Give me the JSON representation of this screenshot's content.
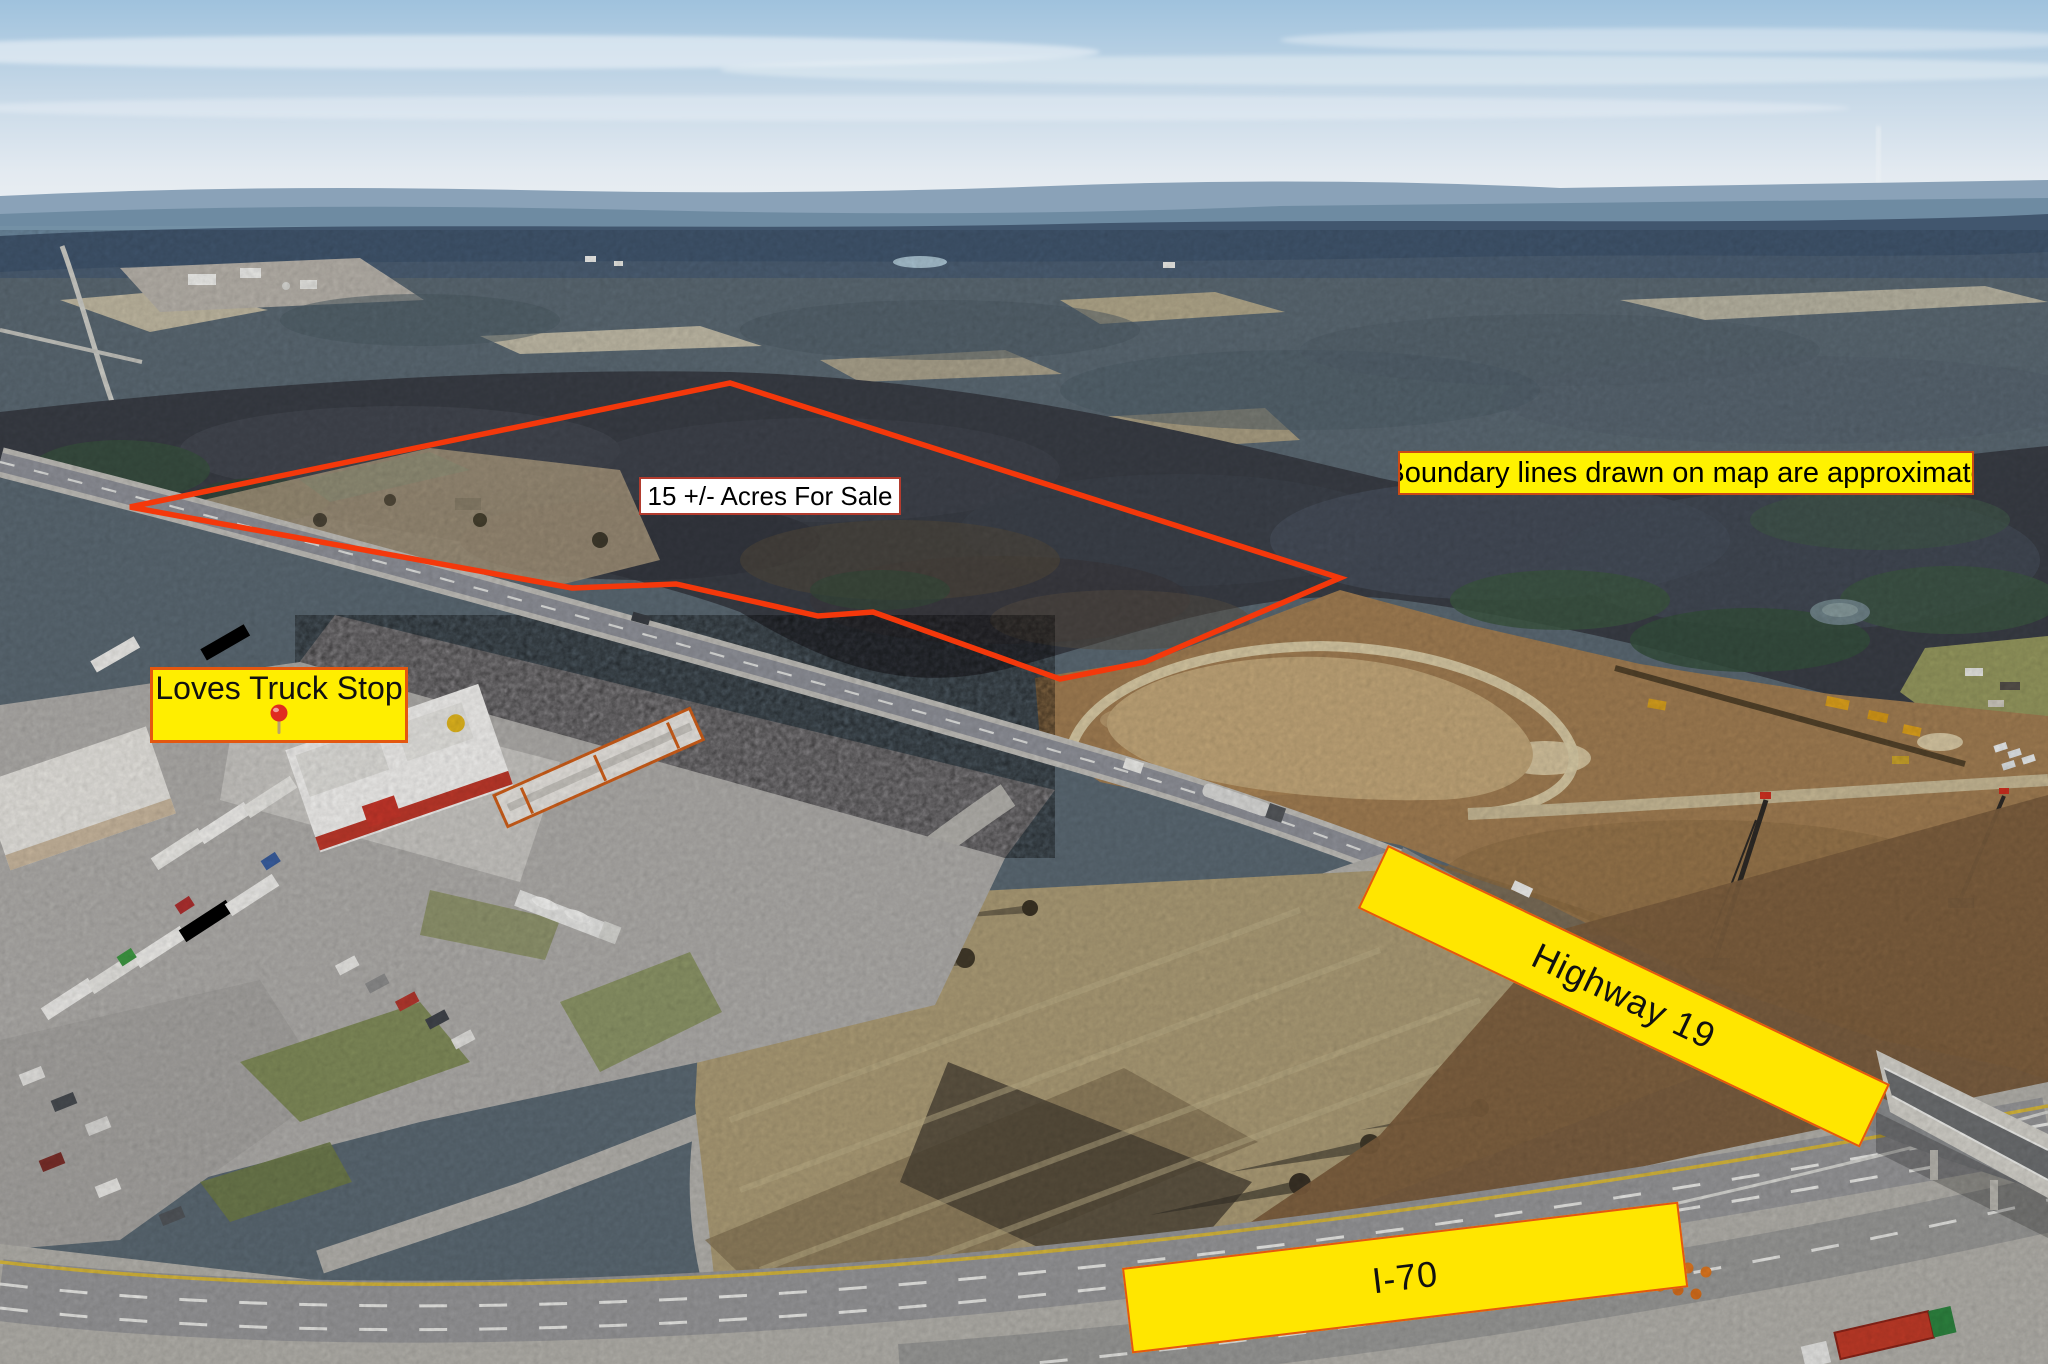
{
  "overlay": {
    "boundary": {
      "points": "130,507 730,383 1340,578 1145,662 1060,679 873,612 818,616 676,584 572,588",
      "color": "#f4380b"
    },
    "acreage_label": {
      "text": "15 +/- Acres For Sale",
      "bg": "#ffffff",
      "border_color": "#b23b2e",
      "text_color": "#000000"
    },
    "disclaimer_label": {
      "text": "Boundary lines drawn on map are approximate",
      "bg": "#fff200",
      "border_color": "#cc4a14",
      "text_color": "#000000"
    },
    "truck_stop_label": {
      "text": "Loves Truck Stop",
      "bg": "#ffee00",
      "border_color": "#e4570f",
      "text_color": "#111111",
      "pin_icon": "map-pin-icon",
      "pin_color": "#e02b20",
      "pin_stem_color": "#b9a36a"
    },
    "highway_banner": {
      "text": "Highway 19",
      "bg": "#ffe600",
      "border_color": "#e4570f",
      "text_color": "#111111"
    },
    "interstate_banner": {
      "text": "I-70",
      "bg": "#ffe600",
      "border_color": "#e4570f",
      "text_color": "#111111"
    }
  }
}
